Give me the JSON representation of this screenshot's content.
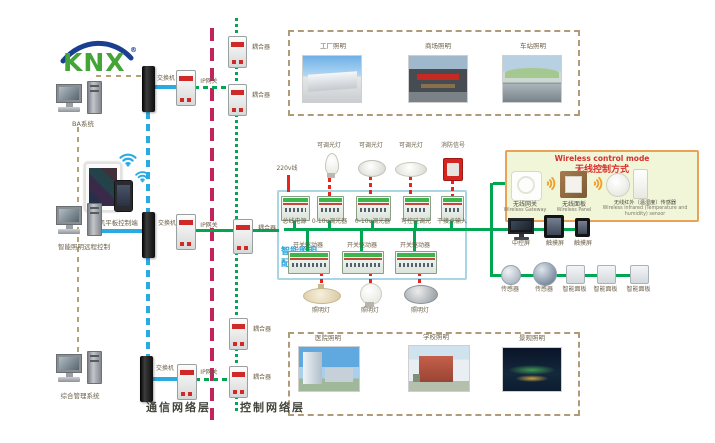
{
  "logo": {
    "brand": "KNX",
    "reg": "®"
  },
  "left": {
    "ba_system": "BA系统",
    "mobile": "手机平板控制端",
    "remote_control": "智能照明远程控制",
    "management": "综合管理系统"
  },
  "network": {
    "switch": "交换机",
    "ip_gateway": "IP网关",
    "coupler": "耦合器"
  },
  "layers": {
    "communication": "通信网络层",
    "control": "控制网络层"
  },
  "top_gallery": {
    "labels": [
      "工厂照明",
      "商场照明",
      "车站照明"
    ]
  },
  "bottom_gallery": {
    "labels": [
      "医院照明",
      "学校照明",
      "景观照明"
    ]
  },
  "cabinet": {
    "title_line1": "智能照明",
    "title_line2": "配电箱",
    "power_in": "220v线",
    "top_modules": [
      "总线电源",
      "0-10v调光器",
      "0-10v调光器",
      "可控硅调光",
      "干接点输入"
    ],
    "lamp_labels": [
      "可调光灯",
      "可调光灯",
      "可调光灯",
      "消防信号"
    ],
    "drivers": [
      "开关驱动器",
      "开关驱动器",
      "开关驱动器"
    ],
    "lamps_bottom": [
      "照明灯",
      "照明灯",
      "照明灯"
    ]
  },
  "wireless": {
    "title_en": "Wireless control mode",
    "title_zh": "无线控制方式",
    "devices": [
      {
        "zh": "无线网关",
        "en": "Wireless Gateway"
      },
      {
        "zh": "无线面板",
        "en": "Wireless Panel"
      },
      {
        "zh": "无线红外（温湿度）传感器",
        "en": "Wireless infrared (Temperature and humidity) sensor"
      }
    ]
  },
  "right": {
    "row1": [
      "中控屏",
      "触摸屏",
      "触摸屏"
    ],
    "row2": [
      "传感器",
      "传感器",
      "智能面板",
      "智能面板",
      "智能面板"
    ]
  },
  "colors": {
    "green_bus": "#00a651",
    "blue_line": "#29abe2",
    "magenta_line": "#c2255c",
    "tan_line": "#b3a279",
    "red_line": "#e8241f",
    "cabinet_border": "#a9d6e5",
    "cabinet_title": "#2aa5dc",
    "wireless_bg": "#f2f6d9",
    "wireless_border": "#e8a25a",
    "wireless_title": "#d63030",
    "knx_green": "#43a535",
    "knx_blue": "#1b3f8f"
  }
}
